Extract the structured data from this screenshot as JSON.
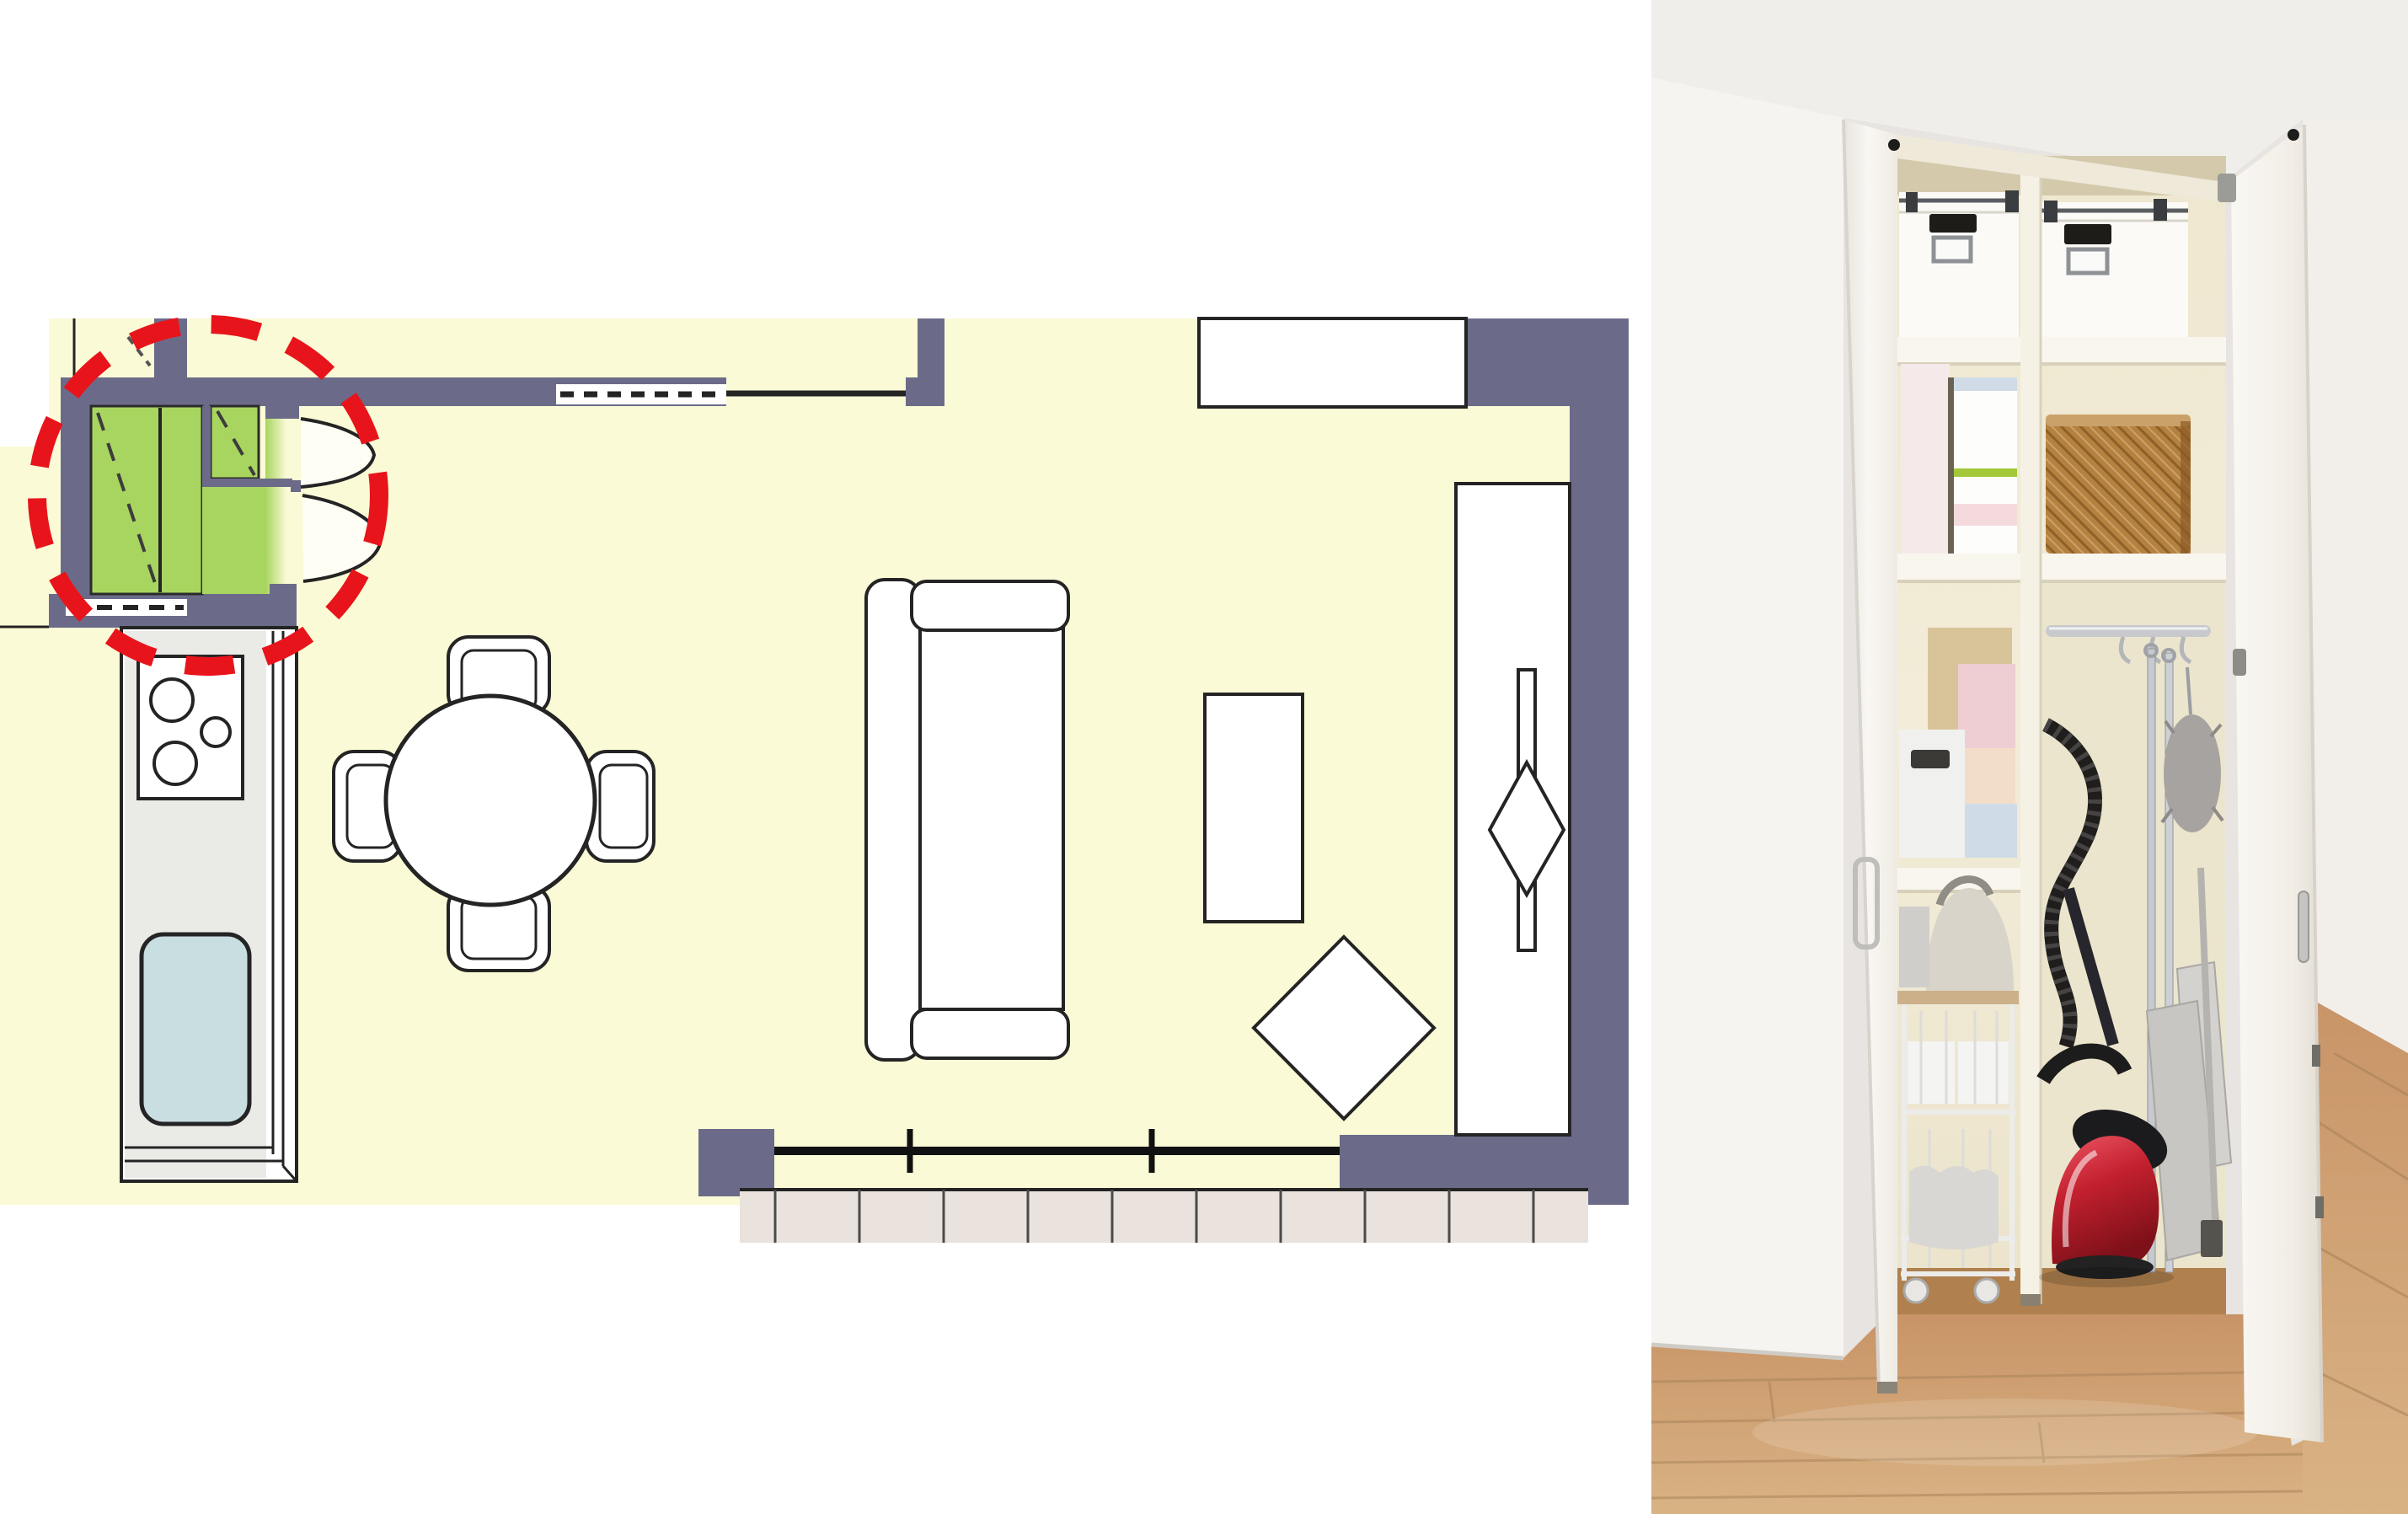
{
  "page": {
    "title": "Entrance storage closet floor plan with storage cabinet photo"
  },
  "colors": {
    "outline": "#242424",
    "wall": "#6b6b89",
    "floor": "#fafad6",
    "closet_green": "#a8d55f",
    "dash_dark": "#3d3d3d",
    "highlight_red": "#e8141b",
    "counter": "#eaeae7",
    "sink": "#c9dee1",
    "deck": "#eae2dc",
    "white": "#ffffff",
    "photo_wall": "#e7e4e1",
    "ceiling": "#f0eeeb",
    "left_wall": "#f6f4f0",
    "right_wall": "#f2efeb",
    "cabinet_cream": "#f2ecd8",
    "cream_shadow": "#d4caab",
    "cream_right": "#ece5cd",
    "shelf": "#f9f6ee",
    "divider": "#f5f1e4",
    "basket": "#b5813f",
    "basket_dark": "#8f5f28",
    "basket_rim": "#caa169",
    "tan_box": "#d9c49a",
    "pink_box": "#f5e9ea",
    "pink": "#eecdd3",
    "peach": "#f2ddc8",
    "blue": "#cfdce8",
    "green_line": "#a3c93a",
    "bin_white": "#f0f1ef",
    "kettle": "#d8d4c9",
    "metal": "#c7c9cc",
    "metal_dark": "#8f9398",
    "duster": "#a7a3a1",
    "dustpan": "#c8c6c2",
    "door": "#f8f6f2",
    "door_edge": "#dcd8d1",
    "hinge": "#1d1d1b",
    "vacuum_red": "#c3202e",
    "vacuum_black": "#1b1b1d",
    "wood": "#c79a6b",
    "wood_dark": "#b0814e",
    "wood_line": "#a9845a"
  },
  "floor_plan": {
    "label": "Living-dining-kitchen floor plan, entrance storage closet highlighted in green with red dashed circle",
    "highlight": {
      "label": "red dashed highlight circle around entrance storage closet"
    },
    "elements": [
      "entrance storage closet (green, two compartments with fold-out double doors)",
      "left wall window (dashed)",
      "sliding door pocket in top wall (dashed)",
      "kitchen counter with 3-burner stove and sink",
      "round dining table with 4 chairs",
      "sofa with back and armrests",
      "coffee table",
      "floor cushion (diamond)",
      "TV board with TV",
      "wall storage cabinet (top right)",
      "bottom window with balcony deck"
    ]
  },
  "photo": {
    "label": "Tall narrow storage cabinet with both doors open, shelves loaded with household items",
    "items": [
      "two white lidded storage boxes with label holders",
      "tissue box packages",
      "rattan basket",
      "stacked pastel boxes (pink, peach, blue)",
      "white bin with handle slot",
      "beige water pot",
      "white wire rolling cart with casters",
      "hanging rail with hooks",
      "mop and broom poles",
      "gray duster",
      "dustpan panels",
      "wall outlet",
      "red canister vacuum cleaner with black hose",
      "light wood flooring"
    ]
  }
}
